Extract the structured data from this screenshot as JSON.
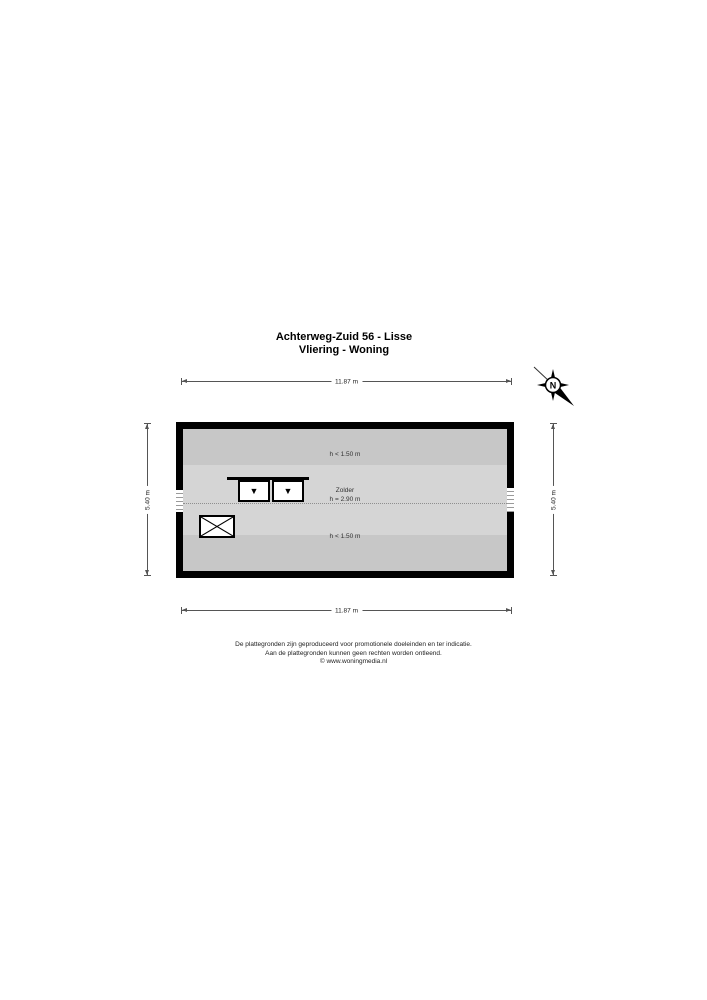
{
  "header": {
    "title_line1": "Achterweg-Zuid 56 - Lisse",
    "title_line2": "Vliering - Woning"
  },
  "compass": {
    "north_label": "N"
  },
  "dimensions": {
    "top": "11.87 m",
    "bottom": "11.87 m",
    "left": "5.40 m",
    "right": "5.40 m"
  },
  "floorplan": {
    "room_label": "Zolder",
    "zones": [
      {
        "position": "top",
        "label": "h < 1.50 m"
      },
      {
        "position": "middle",
        "label": "h = 2.90 m"
      },
      {
        "position": "bottom",
        "label": "h < 1.50 m"
      }
    ]
  },
  "icons": {
    "compass": "compass-rose-north",
    "window_arrow": "▼",
    "stair_void": "crossed-rectangle"
  },
  "colors": {
    "wall": "#000000",
    "zone_low": "#c7c7c7",
    "zone_high": "#d5d5d5",
    "ridge_line": "#8f8f8f"
  },
  "footer": {
    "line1": "De plattegronden zijn geproduceerd voor promotionele doeleinden en ter indicatie.",
    "line2": "Aan de plattegronden kunnen geen rechten worden ontleend.",
    "line3": "© www.woningmedia.nl"
  }
}
